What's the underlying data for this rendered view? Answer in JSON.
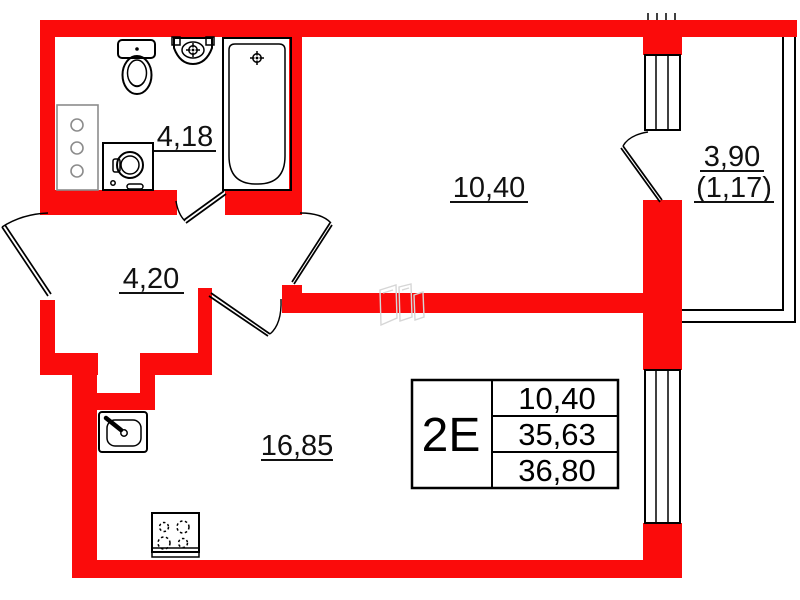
{
  "title": "apartment floor plan",
  "plan": {
    "unit": {
      "type_code": "2Е",
      "areas": {
        "living": "10,40",
        "total": "35,63",
        "total_with_balcony": "36,80"
      }
    },
    "rooms": {
      "bathroom": {
        "label": "4,18"
      },
      "hallway": {
        "label": "4,20"
      },
      "room": {
        "label": "10,40"
      },
      "kitchen_living": {
        "label": "16,85"
      },
      "balcony": {
        "label": "3,90",
        "label_reduced": "(1,17)"
      }
    },
    "fixtures": [
      "toilet",
      "wash-basin",
      "bathtub",
      "washing-machine",
      "cabinet-shelves",
      "kitchen-sink",
      "stove",
      "windows",
      "balcony-door",
      "entrance-door"
    ],
    "colors": {
      "wall": "#fb0b0b",
      "fixture_fill": "#c4c4c4",
      "fixture_dark": "#9a9a9a",
      "outline": "#000000",
      "watermark": "#d6d6d6"
    }
  }
}
